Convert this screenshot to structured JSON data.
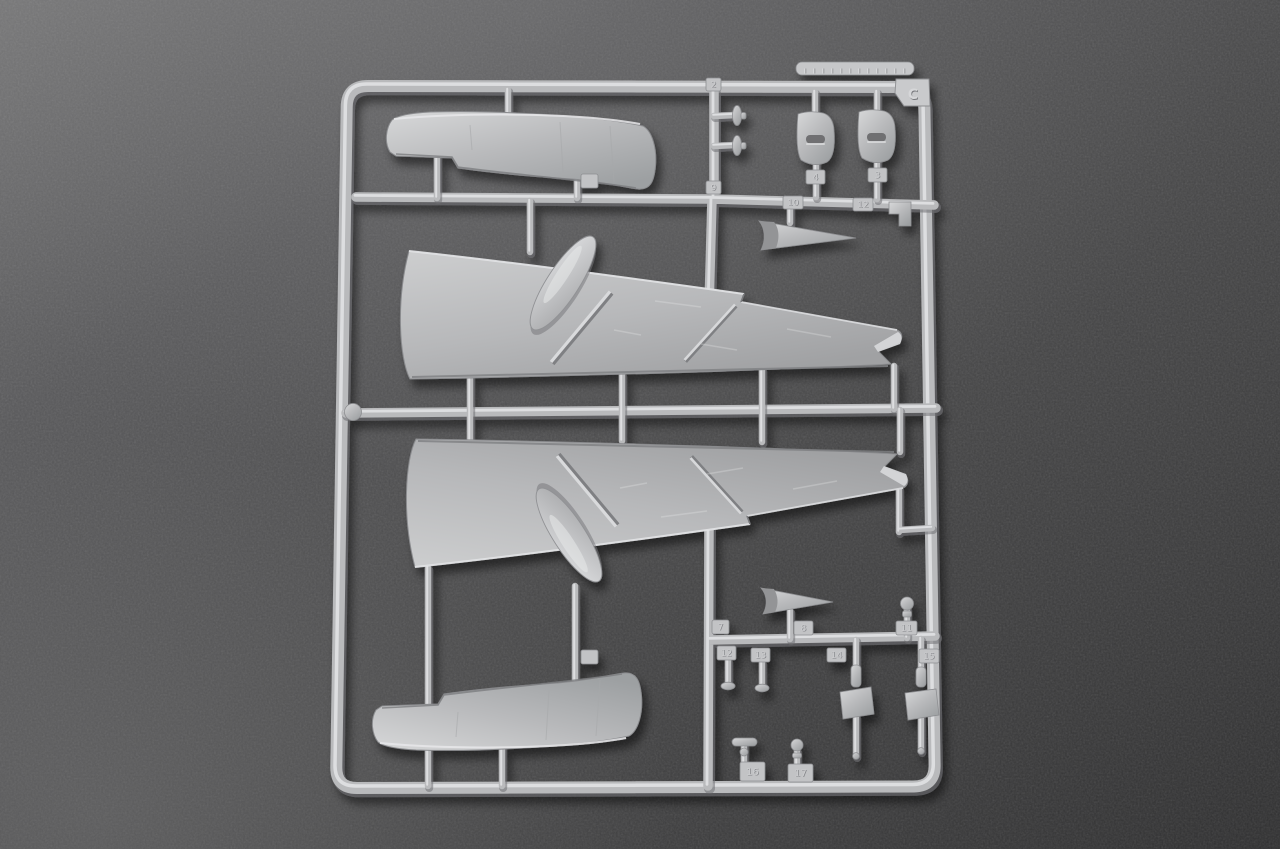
{
  "meta": {
    "type": "photograph",
    "subject": "Plastic model kit sprue (runner) holding aircraft wing halves, slipper fuel-tank halves and small detail parts, lying on a dark gray textured surface"
  },
  "colors": {
    "background": "#4a4a4b",
    "background_light": "#737374",
    "background_dark": "#303031",
    "plastic": "#b9babc",
    "plastic_highlight": "#e3e4e6",
    "plastic_shadow": "#8d8e91",
    "slot_recess": "#6f7072",
    "cast_shadow": "rgba(0,0,0,0.5)"
  },
  "sprue": {
    "letter": "C",
    "tags": [
      "2",
      "9",
      "4",
      "3",
      "10",
      "12",
      "7",
      "8",
      "11",
      "12",
      "13",
      "14",
      "15",
      "16",
      "17"
    ],
    "parts": [
      "outer-frame-rail",
      "wing-upper-half-port",
      "wing-upper-half-starboard",
      "slipper-tank-half-upper",
      "slipper-tank-half-lower",
      "wing-root-fairing",
      "wing-fence-rib",
      "slotted-bracket-part",
      "horn-funnel-part",
      "disc-pin-part",
      "flagged-pin-part",
      "mushroom-pin-part",
      "ball-pin-part",
      "t-bar-valve-part",
      "ball-valve-part",
      "l-bracket-part",
      "part-number-tag",
      "sprue-letter-tag",
      "embossed-brand-strip"
    ]
  }
}
